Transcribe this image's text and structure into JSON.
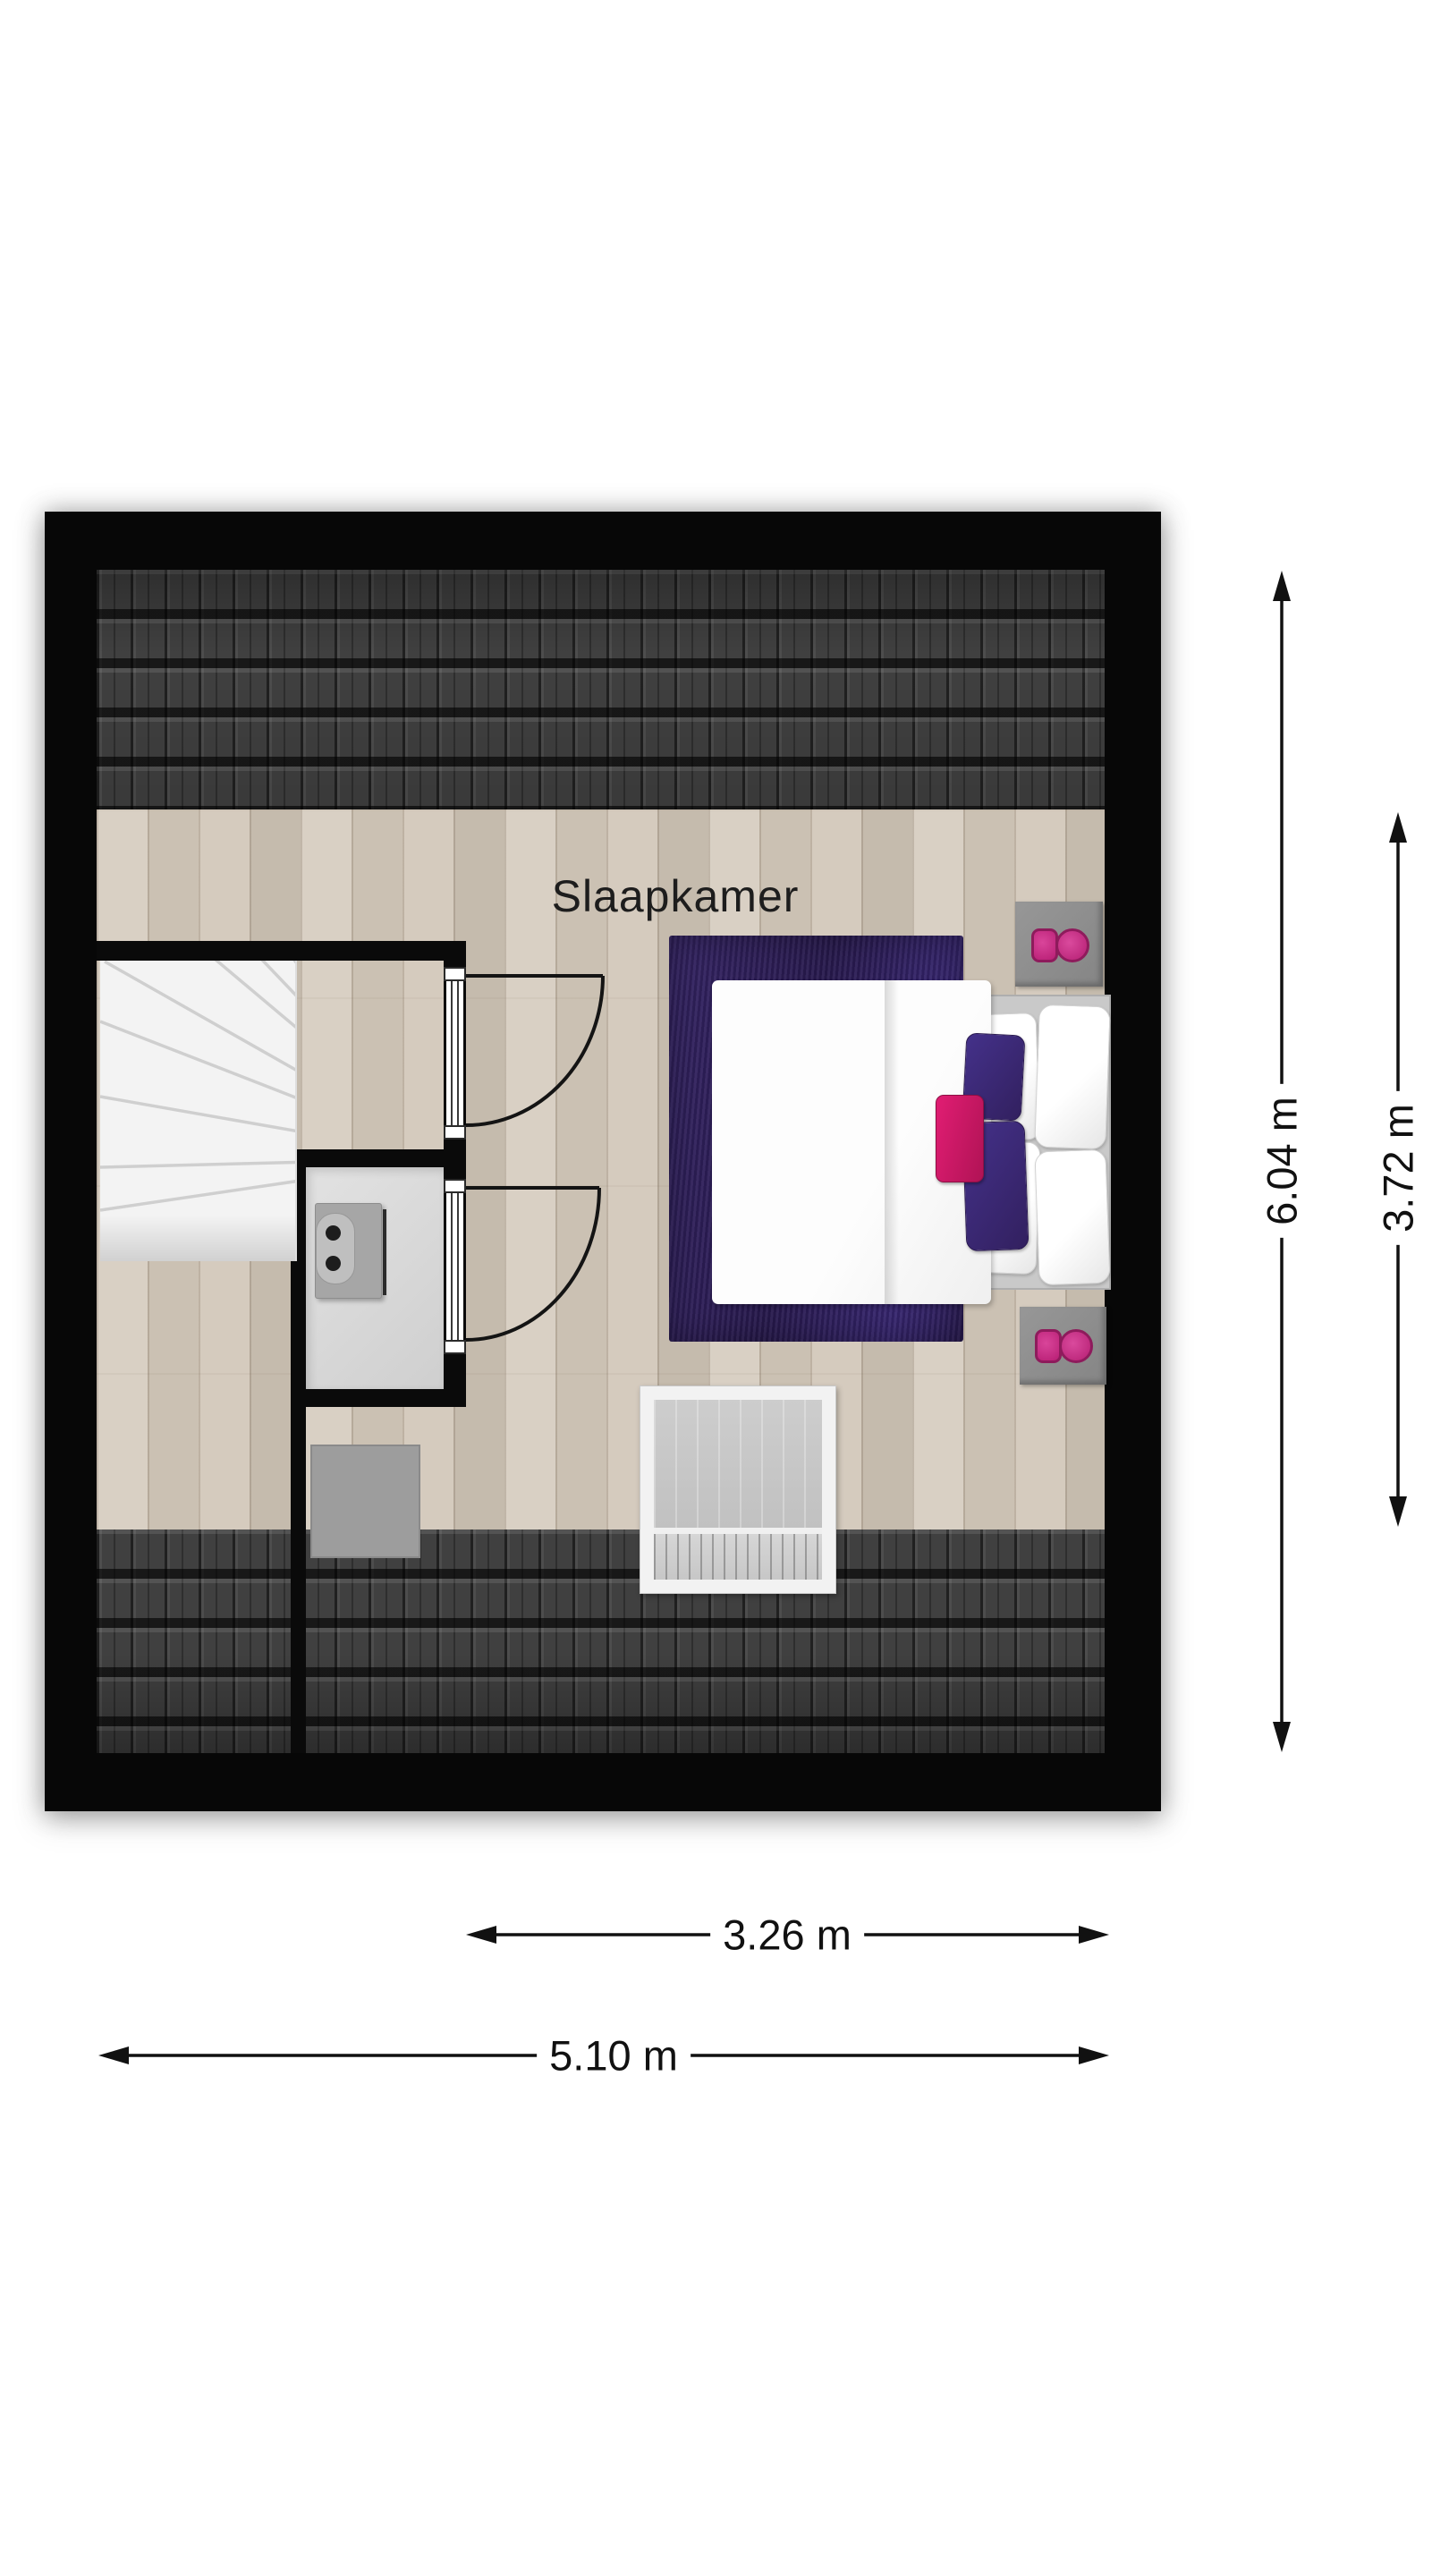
{
  "room": {
    "label": "Slaapkamer"
  },
  "dimensions": {
    "outer_height": "6.04 m",
    "inner_height": "3.72 m",
    "inner_width": "3.26 m",
    "outer_width": "5.10 m"
  },
  "colors": {
    "wall": "#070707",
    "wood_floor": "#d3c9bb",
    "roof_tile": "#404040",
    "stairs": "#f3f3f3",
    "wc_floor": "#dadada",
    "rug": "#31215e",
    "duvet": "#f9f9f9",
    "pillow_purple": "#3b2a74",
    "pillow_pink": "#d01e66",
    "nightstand": "#8f8f8f",
    "nightstand_accent": "#c2267f",
    "window_frame": "#f2f2f2",
    "chimney": "#9d9d9d",
    "dimension_line": "#111111"
  },
  "objects": {
    "bed": "double-bed",
    "rug": "area-rug",
    "nightstand_top": "nightstand",
    "nightstand_bottom": "nightstand",
    "stairs": "winder-staircase",
    "toilet": "toilet",
    "window": "roof-window",
    "chimney": "chimney-block",
    "door_top": "hinged-door",
    "door_bottom": "hinged-door"
  }
}
